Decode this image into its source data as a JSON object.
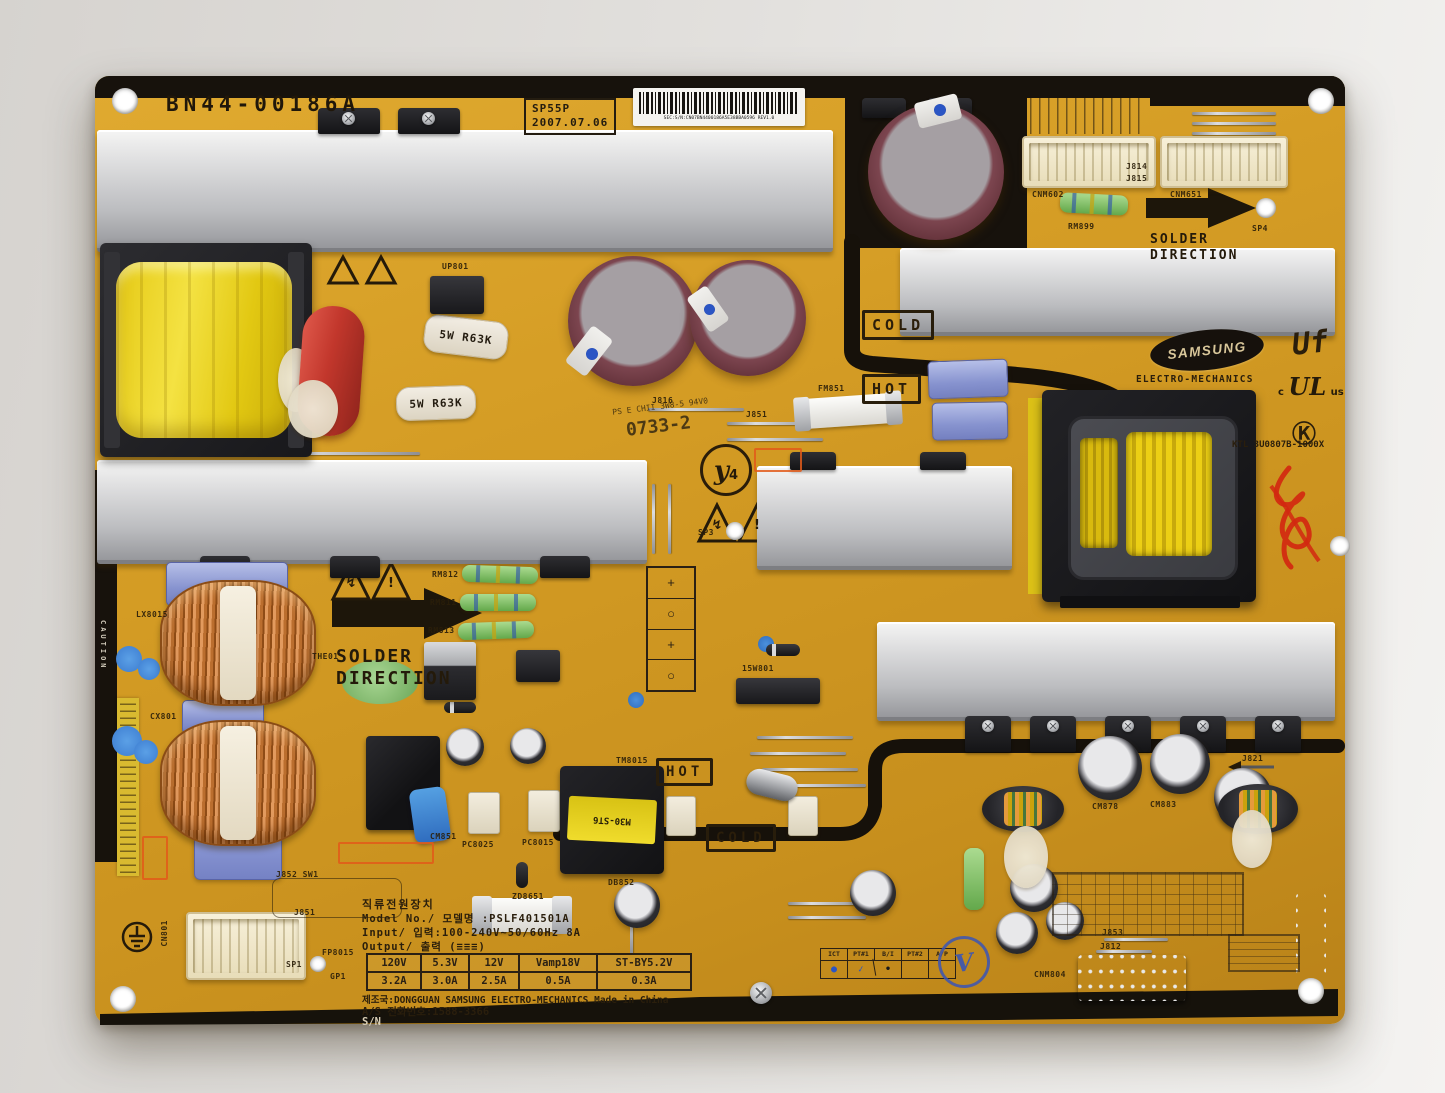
{
  "silkscreen": {
    "part_number": "BN44-00186A",
    "stamp_line1": "SP55P",
    "stamp_line2": "2007.07.06",
    "barcode_text": "SEC:S/N:CN07BN4400186A5E38BBA0596 REV1.0",
    "solder_word1": "SOLDER",
    "solder_word2": "DIRECTION",
    "cold": "COLD",
    "hot": "HOT",
    "date_code": "0733-2",
    "cert_line": "PS E CHII 3W8-5 94V0",
    "y_mark": "y",
    "y_mark_sub": "4",
    "power_resistor_label": "5W R63K",
    "transformer_label": "M30-ST6",
    "caution_vertical": "CAUTION",
    "warn_bolt": "↯",
    "warn_excl": "!"
  },
  "branding": {
    "samsung": "SAMSUNG",
    "division": "ELECTRO-MECHANICS",
    "lf_mark": "Uf",
    "ul_c": "c",
    "ul_core": "UL",
    "ul_us": "us",
    "k_mark": "Ⓚ",
    "ktl_line": "KTL 3U0807B-1000X"
  },
  "spec": {
    "title_kr": "직류전원장치",
    "model_line": "Model No./ 모델명 :PSLF401501A",
    "input_line": "Input/ 입력:100-240V~50/60Hz 8A",
    "output_line": "Output/ 출력 (≡≡≡)",
    "headers": [
      "120V",
      "5.3V",
      "12V",
      "Vamp18V",
      "ST-BY5.2V"
    ],
    "values": [
      "3.2A",
      "3.0A",
      "2.5A",
      "0.5A",
      "0.3A"
    ],
    "made_in": "제조국:DONGGUAN SAMSUNG ELECTRO-MECHANICS Made in China",
    "service_line": "A/S 전화번호:1588-3366",
    "serial_line": "S/N"
  },
  "qc": {
    "headers": [
      "ICT",
      "PT#1",
      "B/I",
      "PT#2",
      "A/P"
    ],
    "stamps": [
      "●",
      "✓",
      "•",
      "",
      ""
    ],
    "v_stamp": "V"
  },
  "refs": {
    "cnm602": "CNM602",
    "cnm651": "CNM651",
    "j814": "J814",
    "j815": "J815",
    "rm899": "RM899",
    "sp4": "SP4",
    "up801": "UP801",
    "fm851": "FM851",
    "sp3": "SP3",
    "the01": "THE01",
    "rm812": "RM812",
    "rm811": "RM811",
    "rm813": "RM813",
    "lx8015": "LX8015",
    "cx801": "CX801",
    "cn801": "CN801",
    "cm851": "CM851",
    "pc8025": "PC8025",
    "pc8015": "PC8015",
    "db852": "DB852",
    "zd8651": "ZD8651",
    "tm8015": "TM8015",
    "isw801": "15W801",
    "cm878": "CM878",
    "cm883": "CM883",
    "j821": "J821",
    "cnm804": "CNM804",
    "j853": "J853",
    "j812": "J812",
    "j852_sw1": "J852 SW1",
    "j851_bot": "J851",
    "fp8015": "FP8015",
    "sp1": "SP1",
    "gp1": "GP1",
    "j816": "J816",
    "j851_top": "J851"
  },
  "aux_marks": [
    "+",
    "○",
    "+",
    "○"
  ]
}
